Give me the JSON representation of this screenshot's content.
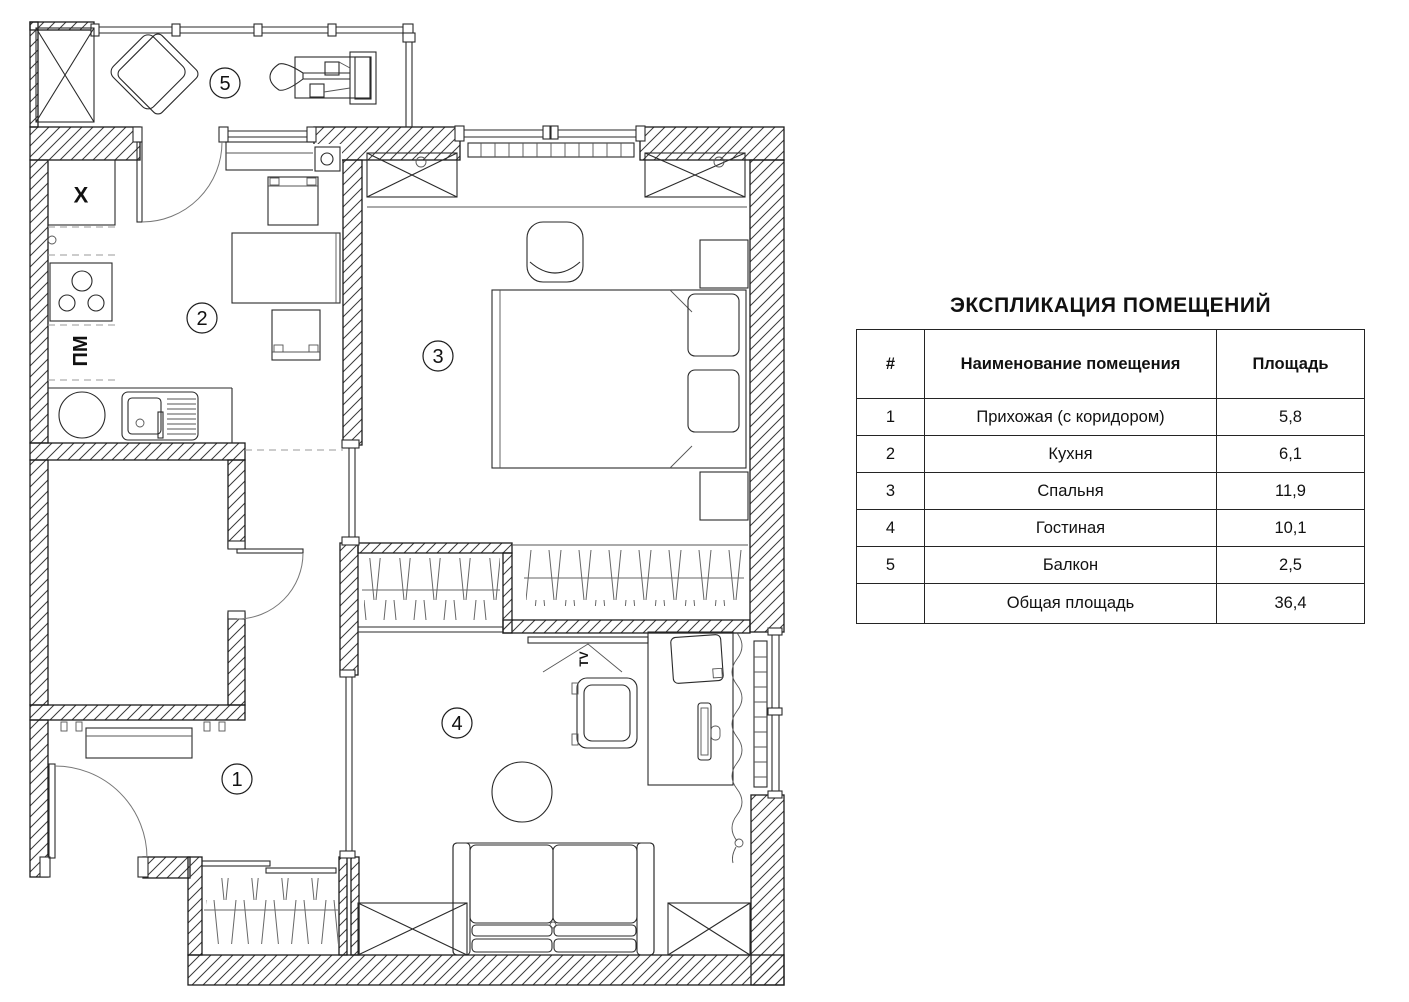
{
  "legend": {
    "title": "ЭКСПЛИКАЦИЯ ПОМЕЩЕНИЙ",
    "headers": {
      "num": "#",
      "name": "Наименование помещения",
      "area": "Площадь"
    },
    "rows": [
      {
        "num": "1",
        "name": "Прихожая (с коридором)",
        "area": "5,8"
      },
      {
        "num": "2",
        "name": "Кухня",
        "area": "6,1"
      },
      {
        "num": "3",
        "name": "Спальня",
        "area": "11,9"
      },
      {
        "num": "4",
        "name": "Гостиная",
        "area": "10,1"
      },
      {
        "num": "5",
        "name": "Балкон",
        "area": "2,5"
      },
      {
        "num": "",
        "name": "Общая площадь",
        "area": "36,4"
      }
    ]
  },
  "plan": {
    "room_labels": {
      "hallway": "1",
      "kitchen": "2",
      "bedroom": "3",
      "living_room": "4",
      "balcony": "5"
    },
    "annotations": {
      "fridge": "X",
      "dishwasher": "ПМ",
      "tv": "TV"
    }
  },
  "colors": {
    "line": "#1c1c1c",
    "hatch": "#3a3a3a",
    "background": "#ffffff"
  }
}
